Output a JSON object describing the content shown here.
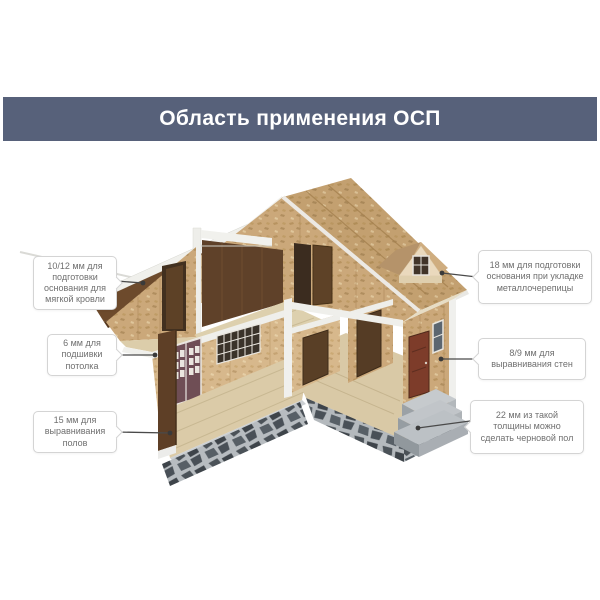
{
  "banner": {
    "title": "Область применения ОСП"
  },
  "callouts": [
    {
      "id": "roof-soft",
      "side": "left",
      "text": "10/12 мм для подготовки основания для мягкой кровли"
    },
    {
      "id": "ceiling-lining",
      "side": "left",
      "text": "6 мм для подшивки потолка"
    },
    {
      "id": "floor-leveling",
      "side": "left",
      "text": "15 мм для выравнивания полов"
    },
    {
      "id": "roof-metal",
      "side": "right",
      "text": "18 мм для подготовки основания при укладке металлочерепицы"
    },
    {
      "id": "wall-leveling",
      "side": "right",
      "text": "8/9 мм для выравнивания стен"
    },
    {
      "id": "subfloor",
      "side": "right",
      "text": "22 мм из такой толщины можно сделать черновой пол"
    }
  ],
  "colors": {
    "banner_bg": "#57617a",
    "banner_text": "#ffffff",
    "callout_border": "#d4d4d4",
    "callout_text": "#6f6f6f",
    "line_color": "#4a4a4a",
    "osb_roof": "#c3a070",
    "osb_wall": "#cba87a",
    "osb_light": "#d7b88c",
    "roof_brown": "#6d4a2c",
    "attic_brown": "#5f4129",
    "floor_beige": "#dbcba8",
    "ceiling_beige": "#ddd0ae",
    "stone_dark": "#4b5258",
    "concrete": "#c1c5c9",
    "trim_white": "#f0f0ec"
  }
}
